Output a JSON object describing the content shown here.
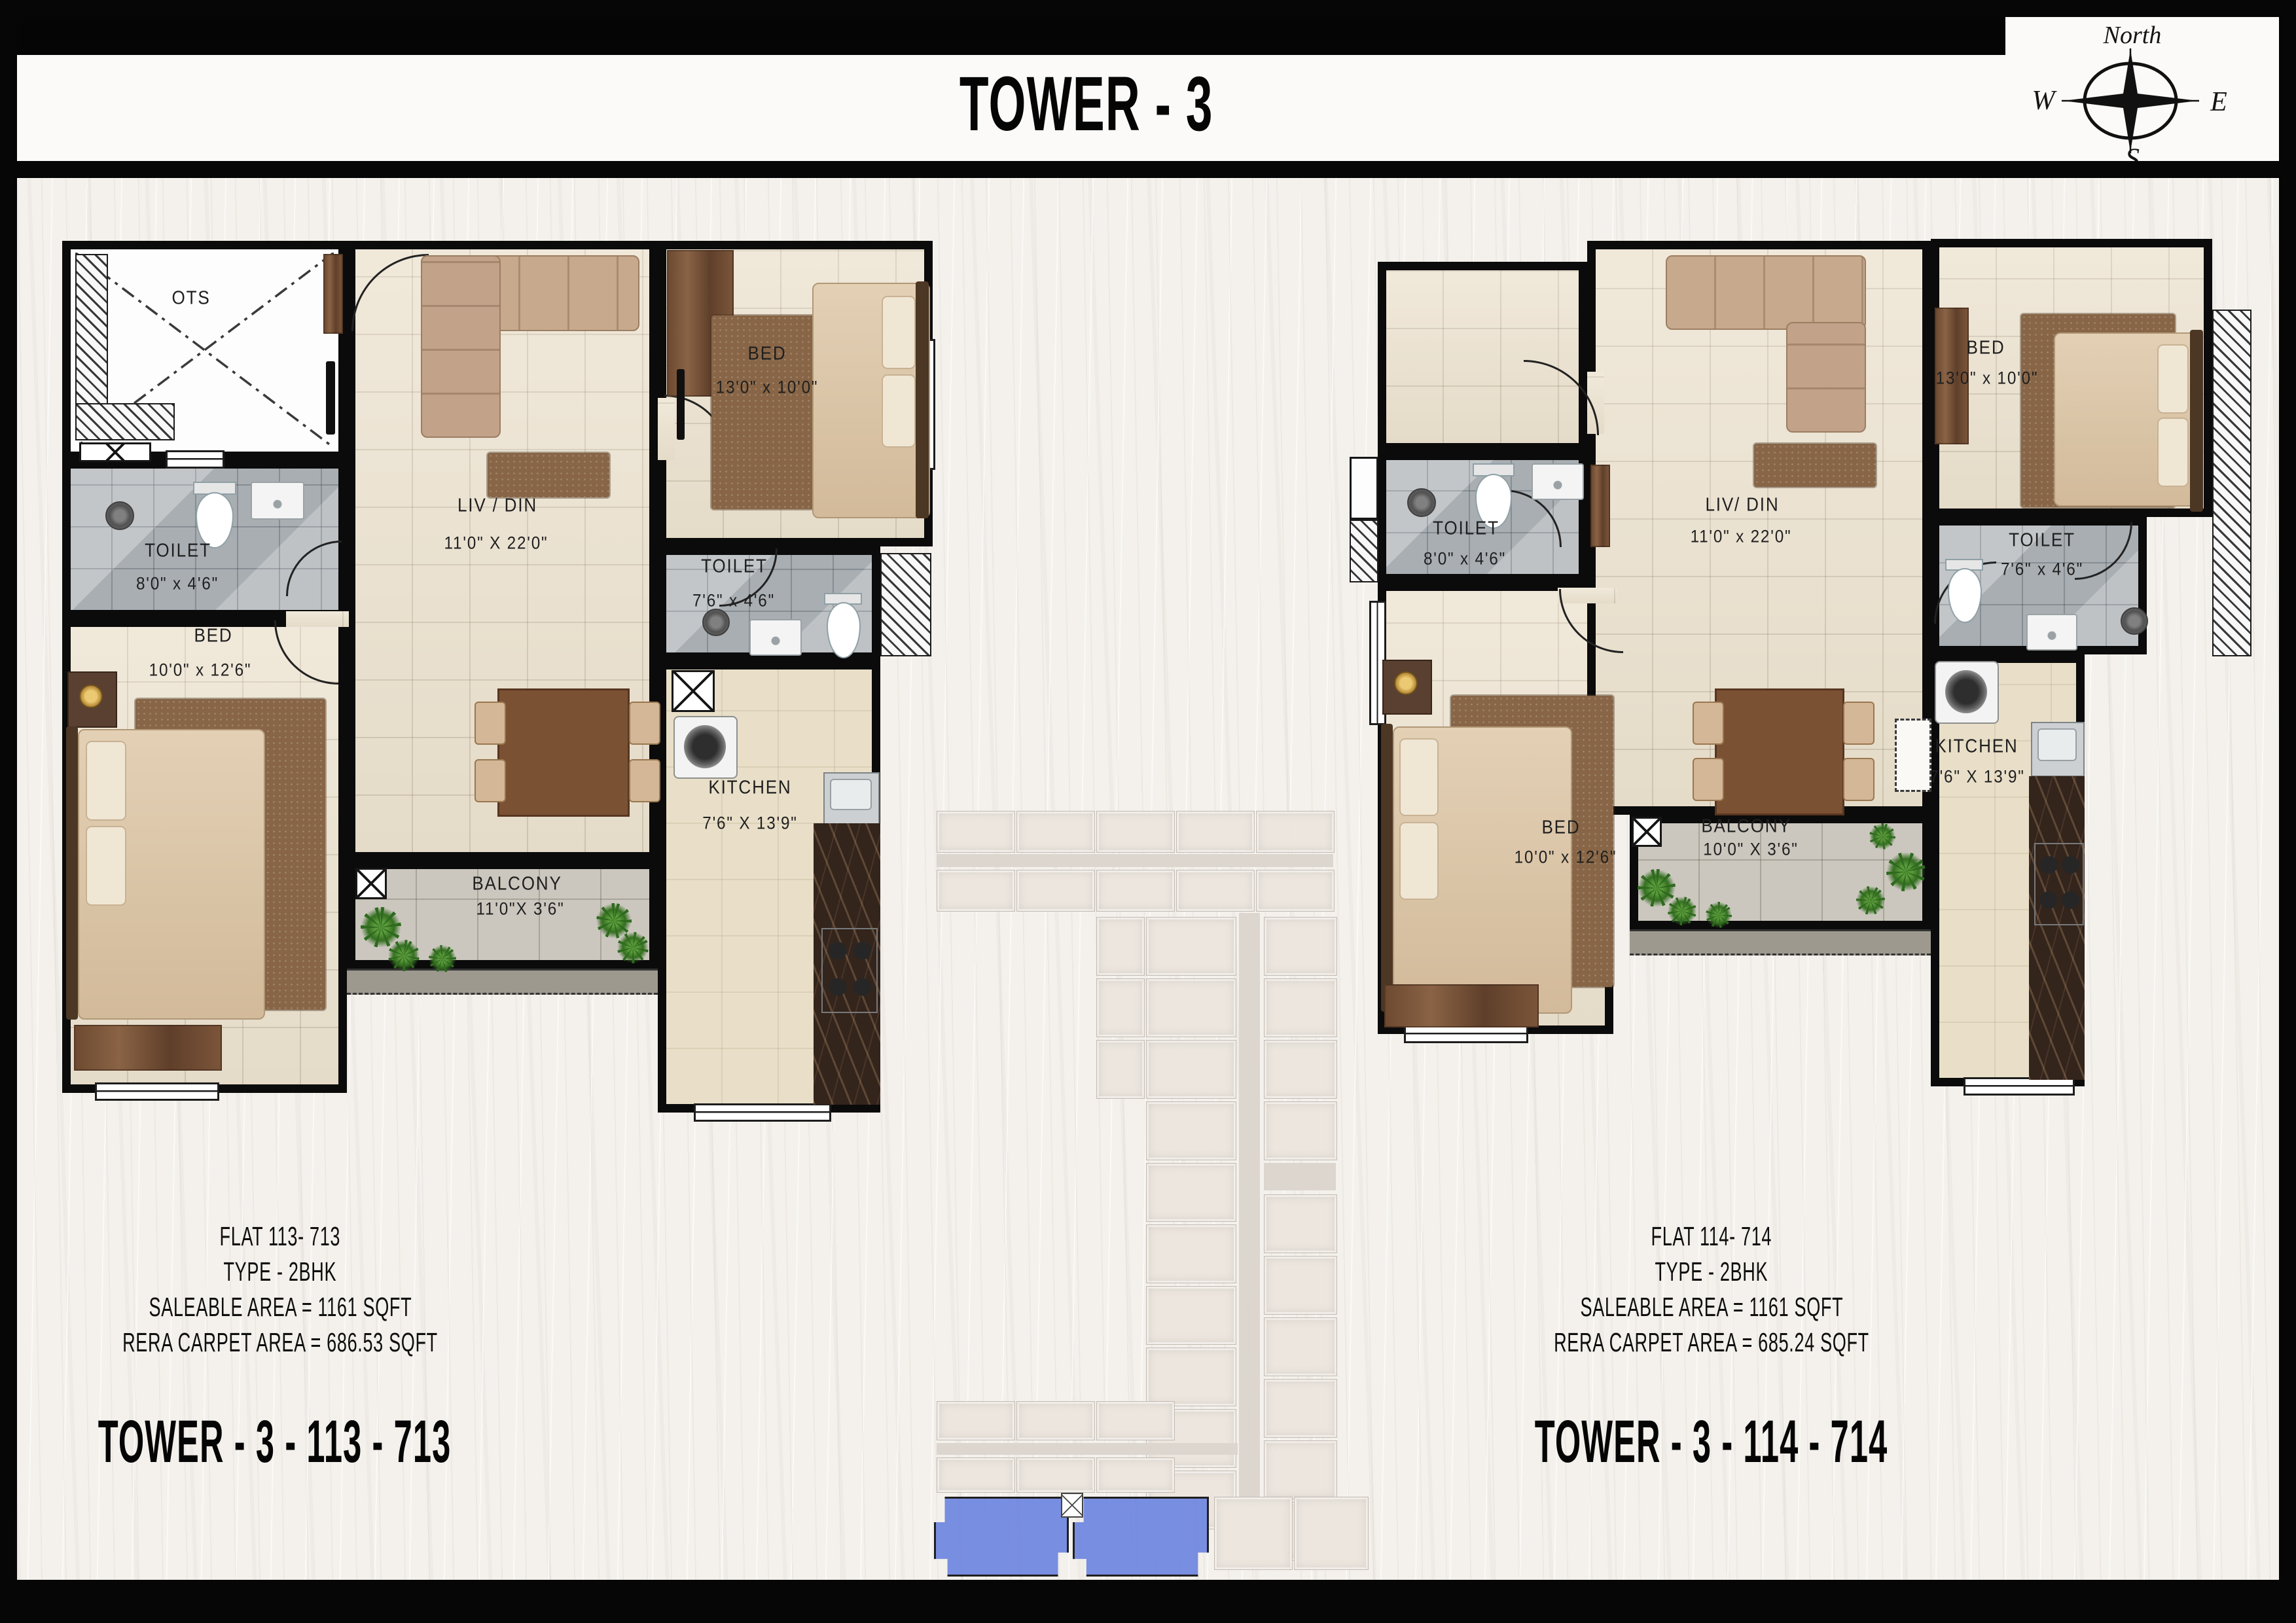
{
  "header": {
    "title": "TOWER -  3"
  },
  "compass": {
    "north": "North",
    "west": "W",
    "east": "E",
    "south": "S"
  },
  "flat_left": {
    "rooms": {
      "ots": "OTS",
      "toilet_a_name": "TOILET",
      "toilet_a_dim": "8'0\" x 4'6\"",
      "bed_a_name": "BED",
      "bed_a_dim": "10'0\" x 12'6\"",
      "liv_name": "LIV / DIN",
      "liv_dim": "11'0\" X 22'0\"",
      "bed_b_name": "BED",
      "bed_b_dim": "13'0\" x 10'0\"",
      "toilet_b_name": "TOILET",
      "toilet_b_dim": "7'6\" x 4'6\"",
      "kitchen_name": "KITCHEN",
      "kitchen_dim": "7'6\" X 13'9\"",
      "balcony_name": "BALCONY",
      "balcony_dim": "11'0\"X 3'6\""
    },
    "info": [
      "FLAT 113- 713",
      "TYPE - 2BHK",
      "SALEABLE AREA = 1161 SQFT",
      "RERA CARPET AREA = 686.53 SQFT"
    ],
    "caption": "TOWER -  3 - 113 - 713"
  },
  "flat_right": {
    "rooms": {
      "toilet_a_name": "TOILET",
      "toilet_a_dim": "8'0\" x 4'6\"",
      "bed_a_name": "BED",
      "bed_a_dim": "10'0\" x 12'6\"",
      "liv_name": "LIV/ DIN",
      "liv_dim": "11'0\" x 22'0\"",
      "bed_b_name": "BED",
      "bed_b_dim": "13'0\" x 10'0\"",
      "toilet_b_name": "TOILET",
      "toilet_b_dim": "7'6\" x 4'6\"",
      "kitchen_name": "KITCHEN",
      "kitchen_dim": "7'6\" X 13'9\"",
      "balcony_name": "BALCONY",
      "balcony_dim": "10'0\" X 3'6\""
    },
    "info": [
      "FLAT 114- 714",
      "TYPE - 2BHK",
      "SALEABLE AREA = 1161 SQFT",
      "RERA CARPET AREA = 685.24 SQFT"
    ],
    "caption": "TOWER -  3 - 114 - 714"
  },
  "colors": {
    "highlight_blue": "#7289e0",
    "wall": "#0b0b0b"
  }
}
